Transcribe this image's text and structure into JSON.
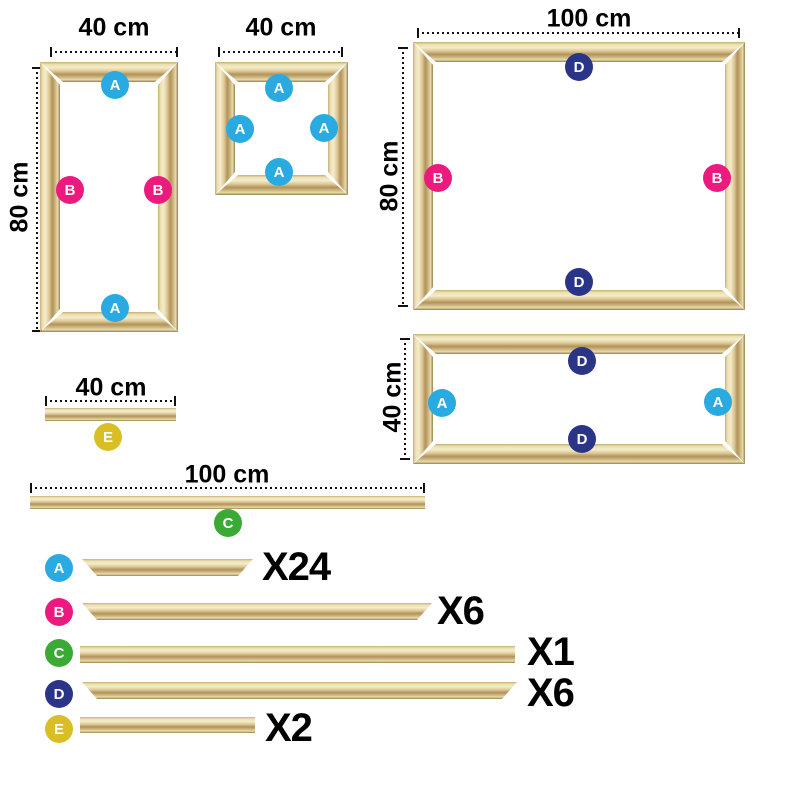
{
  "badge_colors": {
    "A": "#29abe2",
    "B": "#ec1a7e",
    "C": "#3aaa35",
    "D": "#2a3588",
    "E": "#d9bf25"
  },
  "frames": {
    "tall": {
      "width_label": "40 cm",
      "height_label": "80 cm",
      "badges": [
        "A",
        "B",
        "B",
        "A"
      ]
    },
    "square": {
      "width_label": "40 cm",
      "badges": [
        "A",
        "A",
        "A",
        "A"
      ]
    },
    "large": {
      "width_label": "100 cm",
      "height_label": "80 cm",
      "badges": [
        "D",
        "B",
        "B",
        "D"
      ]
    },
    "wide": {
      "height_label": "40 cm",
      "badges": [
        "D",
        "A",
        "A",
        "D"
      ]
    }
  },
  "loose_bars": {
    "short": {
      "length_label": "40 cm",
      "badge": "E"
    },
    "long": {
      "length_label": "100 cm",
      "badge": "C"
    }
  },
  "legend": {
    "rows": [
      {
        "letter": "A",
        "count": "X24"
      },
      {
        "letter": "B",
        "count": "X6"
      },
      {
        "letter": "C",
        "count": "X1"
      },
      {
        "letter": "D",
        "count": "X6"
      },
      {
        "letter": "E",
        "count": "X2"
      }
    ]
  }
}
